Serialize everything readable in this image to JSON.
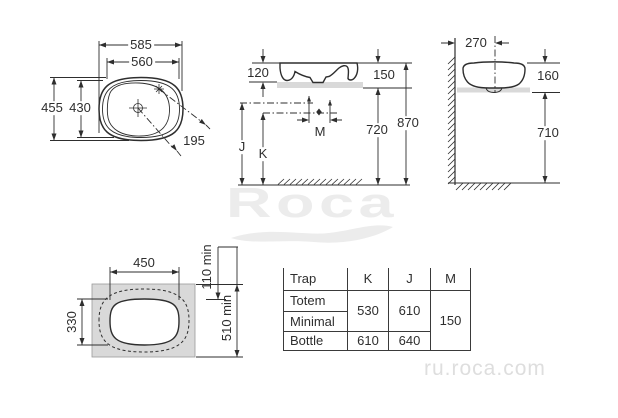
{
  "drawing_labels": {
    "plan": {
      "overall_width": "585",
      "inner_width": "560",
      "overall_depth": "455",
      "inner_depth": "430",
      "drain_to_tap": "195"
    },
    "front": {
      "basin_above_counter": "120",
      "rim_to_counter_bottom": "150",
      "counter_to_floor": "720",
      "rim_to_floor": "870",
      "m": "M",
      "j": "J",
      "k": "K"
    },
    "side": {
      "wall_to_center": "270",
      "basin_height": "160",
      "counter_to_floor": "710"
    },
    "cutout": {
      "cut_width": "450",
      "cut_depth": "330",
      "back_clearance": "110 min",
      "min_depth": "510 min"
    }
  },
  "trap_table": {
    "headers": [
      "Trap",
      "K",
      "J",
      "M"
    ],
    "row_labels": [
      "Totem",
      "Minimal",
      "Bottle"
    ],
    "k_totem_minimal": "530",
    "j_totem_minimal": "610",
    "m_all": "150",
    "k_bottle": "610",
    "j_bottle": "640"
  },
  "watermarks": {
    "brand": "Roca",
    "site": "ru.roca.com"
  },
  "colors": {
    "line": "#2e2e2e",
    "counter_fill": "#d9d9d9",
    "watermark": "#ececec"
  }
}
